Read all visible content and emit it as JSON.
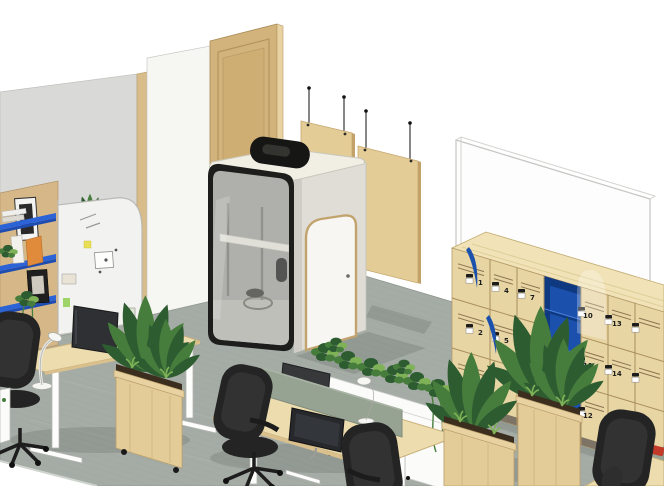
{
  "scene": {
    "description": "Isometric 3D rendering of a modern office interior: acoustic phone booth with glass door, height-adjustable desks with monitors, lamps and mesh task chairs, mobile wooden planters with plants, a numbered locker wall with blue open shelving, two suspended acoustic panels, a glassboard, an arched whiteboard with sticky notes and a cork pegboard with blue shelves."
  },
  "theme": {
    "bg": "#ffffff",
    "carpet": "#a5aca6",
    "carpet-line": "#97a098",
    "wall-gray": "#d9d9d7",
    "wall-white": "#f6f6f3",
    "frame-wood": "#d8bc8a",
    "door-wood": "#d2b37c",
    "door-wood-dark": "#b2955f",
    "door-wood-light": "#e9d2a2",
    "panel-tan": "#e4cc96",
    "panel-edge": "#c3a269",
    "booth-cream": "#f1eee3",
    "booth-side": "#dfddd5",
    "booth-frame": "#1d1d1b",
    "booth-glass": "#b4b6b0",
    "locker-wood": "#e8d5a4",
    "locker-top": "#f1e3b7",
    "locker-seam": "#a98f5c",
    "locker-blue": "#1b51ad",
    "locker-blue-dark": "#0f3a82",
    "plinth": "#7d7466",
    "shelf-blue": "#2c63d6",
    "cork": "#d6b888",
    "board-white": "#f2f2f0",
    "desk-wood": "#ecdcae",
    "desk-edge": "#c9b07a",
    "divider": "#97a392",
    "chair": "#242424",
    "chair-light": "#323232",
    "credenza": "#fbfbfa",
    "plant-dark": "#2e5c31",
    "plant-mid": "#477d3c",
    "plant-light": "#7fb257",
    "soil": "#3c2e1f",
    "metal": "#b9b9b6",
    "accent-red": "#c23a28",
    "sticky-yellow": "#e8df56",
    "sticky-green": "#9fd468"
  },
  "lockers": {
    "numbers": [
      "1",
      "2",
      "3",
      "4",
      "5",
      "7",
      "8",
      "10",
      "11",
      "12",
      "13",
      "14"
    ]
  }
}
